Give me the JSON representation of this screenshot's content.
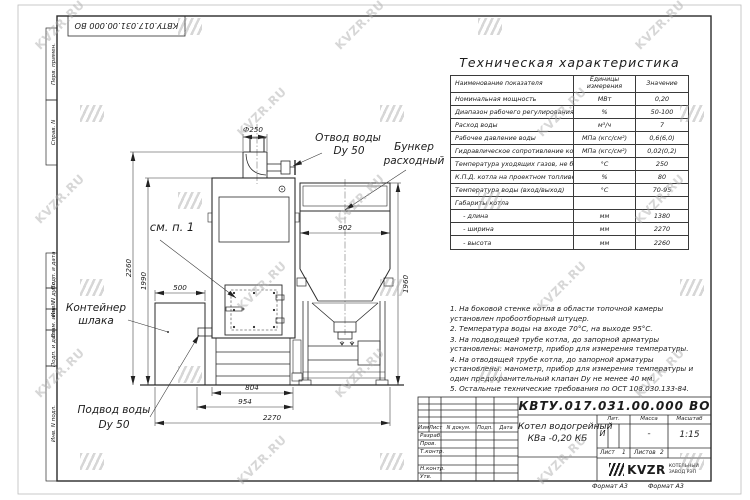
{
  "sheet": {
    "watermark": "KVZR.RU",
    "format_note_left": "Формат А3",
    "format_note_right": "Формат А3"
  },
  "top_stamp": {
    "doc_number": "КВТУ.017.031.00.000  ВО"
  },
  "side_stamp": {
    "labels": [
      "Перв. примен.",
      "Справ. N",
      "Подп. и дата",
      "Инв. N дубл.",
      "Взам. инв. N",
      "Подп. и дата",
      "Инв. N подл."
    ]
  },
  "spec_table": {
    "title": "Техническая характеристика",
    "col_name": "Наименование показателя",
    "col_units": "Единицы измерения",
    "col_value": "Значение",
    "rows": [
      [
        "Номинальная мощность",
        "МВт",
        "0,20"
      ],
      [
        "Диапазон рабочего регулирования",
        "%",
        "50-100"
      ],
      [
        "Расход воды",
        "м³/ч",
        "7"
      ],
      [
        "Рабочее давление воды",
        "МПа (кгс/см²)",
        "0,6(6,0)"
      ],
      [
        "Гидравлическое сопротивление котла",
        "МПа (кгс/см²)",
        "0,02(0,2)"
      ],
      [
        "Температура уходящих газов, не более",
        "°С",
        "250"
      ],
      [
        "К.П.Д. котла на проектном топливе",
        "%",
        "80"
      ],
      [
        "Температура воды (вход/выход)",
        "°С",
        "70-95"
      ],
      [
        "Габариты котла",
        "",
        ""
      ],
      [
        "    - длина",
        "мм",
        "1380"
      ],
      [
        "    - ширина",
        "мм",
        "2270"
      ],
      [
        "    - высота",
        "мм",
        "2260"
      ]
    ]
  },
  "notes": [
    "1.  На боковой стенке котла в области топочной камеры установлен пробоотборный штуцер.",
    "2.  Температура воды на входе  70°С, на выходе  95°С.",
    "3.  На подводящей трубе котла, до запорной арматуры установлены: манометр, прибор для измерения температуры.",
    "4.  На отводящей трубе котла, до запорной арматуры установлены: манометр, прибор для измерения температуры и один предохранительный клапан Dу не менее  40 мм.",
    "5.  Остальные технические требования по ОСТ  108.030.133-84."
  ],
  "drawing": {
    "labels": {
      "see_item": "см. п. 1",
      "outlet_line1": "Отвод воды",
      "outlet_line2": "Dy 50",
      "bunker_line1": "Бункер",
      "bunker_line2": "расходный",
      "slag_line1": "Контейнер",
      "slag_line2": "шлака",
      "inlet_line1": "Подвод воды",
      "inlet_line2": "Dy 50"
    },
    "dims": {
      "chimney": "Ф250",
      "bunker_width": "902",
      "slag_width": "500",
      "total_height": "2260",
      "boiler_height": "1990",
      "bunker_height": "1960",
      "boiler_width": "804",
      "base_width": "954",
      "total_width": "2270"
    }
  },
  "title_block": {
    "doc_number": "КВТУ.017.031.00.000  ВО",
    "title_line1": "Котел водогрейный",
    "title_line2": "КВа -0,20  КБ",
    "header_cols": [
      "Изм",
      "Лист",
      "N докум.",
      "Подп.",
      "Дата"
    ],
    "sign_rows": [
      "Разраб.",
      "Пров.",
      "Т.контр.",
      "",
      "Н.контр.",
      "Утв."
    ],
    "lit_label": "Лит.",
    "lit_value": "И",
    "mass_label": "Масса",
    "mass_value": "-",
    "scale_label": "Масштаб",
    "scale_value": "1:15",
    "sheet_label": "Лист",
    "sheet_value": "1",
    "sheets_label": "Листов",
    "sheets_value": "2",
    "logo_text": "KVZR",
    "logo_sub1": "КОТЕЛЬНЫЙ",
    "logo_sub2": "ЗАВОД РЭП"
  }
}
